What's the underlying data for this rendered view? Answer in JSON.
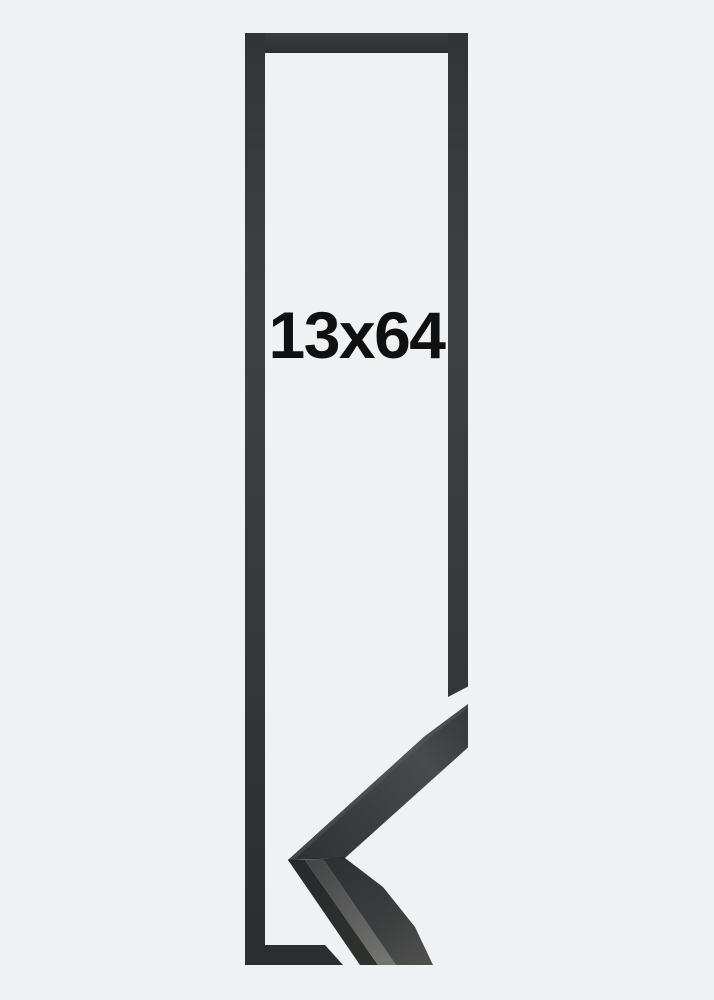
{
  "product_image": {
    "size_label": "13x64",
    "colors": {
      "background": "#f0f1f2",
      "frame_dark": "#313335",
      "frame_dark_deep": "#2b2d2f",
      "corner_sheen": "#484a4d",
      "profile_band_light": "#737472",
      "label_text": "#101010"
    }
  }
}
